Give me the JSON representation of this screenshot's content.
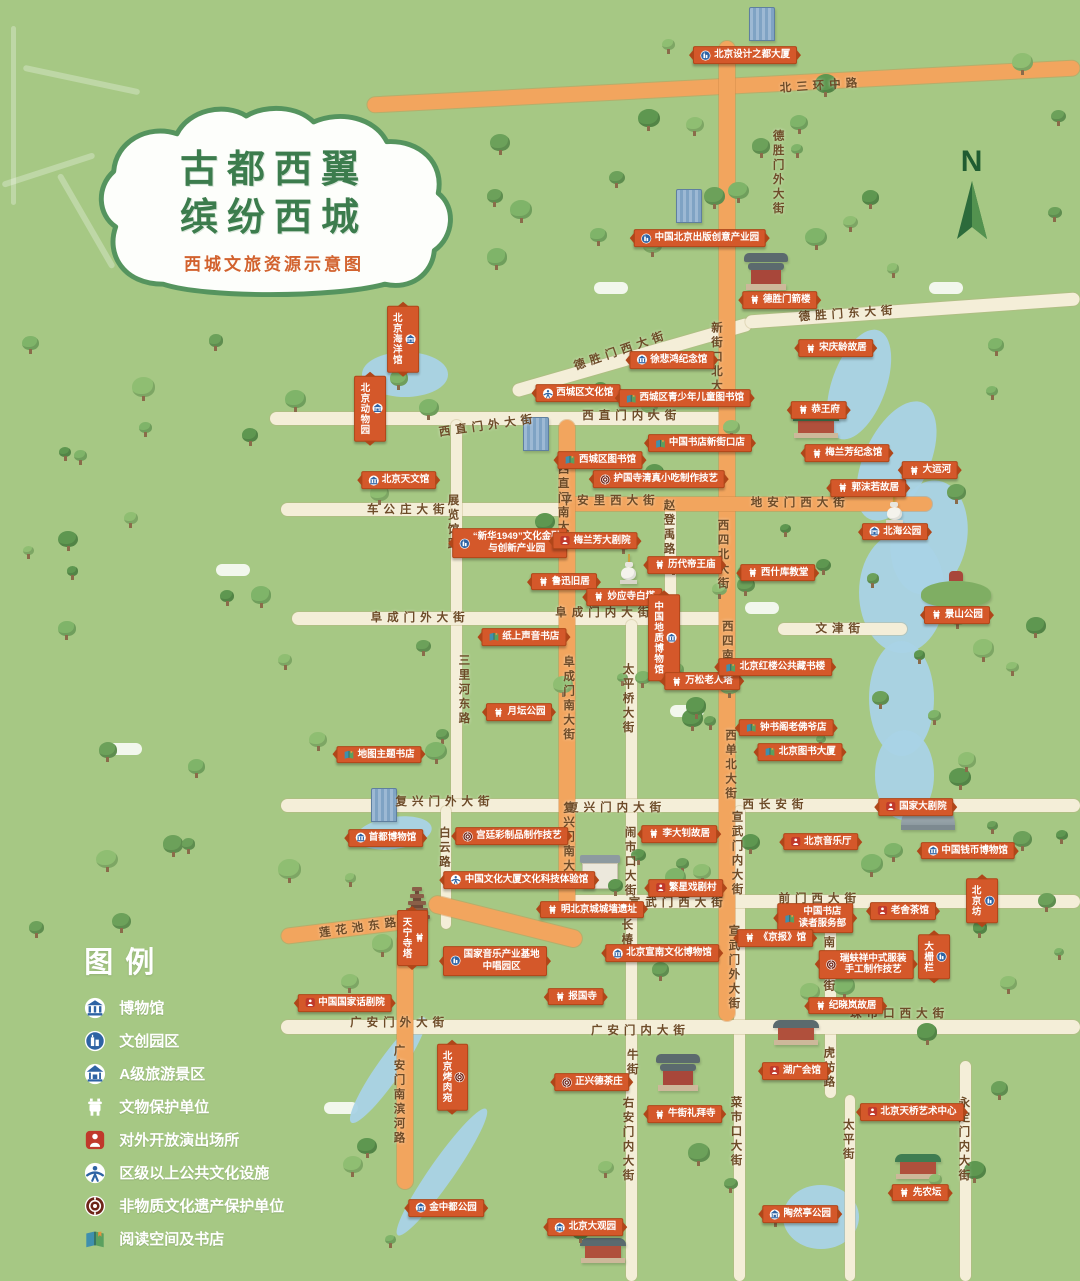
{
  "title": {
    "line1": "古都西翼",
    "line2": "缤纷西城",
    "subtitle": "西城文旅资源示意图"
  },
  "compass": {
    "label": "N"
  },
  "colors": {
    "background": "#a6c884",
    "road_main": "#f2a55e",
    "road_secondary": "#f4eed8",
    "water": "#a9d3e6",
    "banner": "#d4582a",
    "title_green": "#3c7c4d",
    "subtitle_orange": "#d2622e"
  },
  "legend": {
    "title": "图例",
    "items": [
      {
        "type": "museum",
        "label": "博物馆"
      },
      {
        "type": "creative",
        "label": "文创园区"
      },
      {
        "type": "scenic",
        "label": "A级旅游景区"
      },
      {
        "type": "heritage",
        "label": "文物保护单位"
      },
      {
        "type": "performance",
        "label": "对外开放演出场所"
      },
      {
        "type": "culture",
        "label": "区级以上公共文化设施"
      },
      {
        "type": "ich",
        "label": "非物质文化遗产保护单位"
      },
      {
        "type": "bookstore",
        "label": "阅读空间及书店"
      }
    ]
  },
  "map": {
    "orange_segments": [
      {
        "x": 34,
        "y": 6.2,
        "w": 66,
        "h": 1.2,
        "rot": -3
      },
      {
        "x": 66.6,
        "y": 3.2,
        "w": 1.5,
        "h": 76.5
      },
      {
        "x": 52.3,
        "y": 38.8,
        "w": 34,
        "h": 1.1
      },
      {
        "x": 51.8,
        "y": 32.8,
        "w": 1.4,
        "h": 38.6
      },
      {
        "x": 39.5,
        "y": 71.3,
        "w": 14.5,
        "h": 1.3,
        "rot": 14
      },
      {
        "x": 36.8,
        "y": 72.8,
        "w": 1.4,
        "h": 20
      },
      {
        "x": 26,
        "y": 71.9,
        "w": 12.5,
        "h": 1.2,
        "rot": -7
      }
    ],
    "cream_segments": [
      {
        "x": 47,
        "y": 27.4,
        "w": 23,
        "h": 1,
        "rot": -16
      },
      {
        "x": 69,
        "y": 23.7,
        "w": 31,
        "h": 1,
        "rot": -4
      },
      {
        "x": 25,
        "y": 32.2,
        "w": 43,
        "h": 1
      },
      {
        "x": 26,
        "y": 39.3,
        "w": 26.5,
        "h": 1
      },
      {
        "x": 41.8,
        "y": 32.8,
        "w": 1,
        "h": 29.8
      },
      {
        "x": 27,
        "y": 47.8,
        "w": 40.5,
        "h": 1
      },
      {
        "x": 61.6,
        "y": 39.6,
        "w": 1,
        "h": 8.4
      },
      {
        "x": 58,
        "y": 48.4,
        "w": 1,
        "h": 51.6
      },
      {
        "x": 72,
        "y": 48.6,
        "w": 12,
        "h": 1
      },
      {
        "x": 26,
        "y": 62.4,
        "w": 74,
        "h": 1
      },
      {
        "x": 40.8,
        "y": 62.9,
        "w": 1,
        "h": 9.6
      },
      {
        "x": 68,
        "y": 62.9,
        "w": 1,
        "h": 37.1
      },
      {
        "x": 52.8,
        "y": 69.9,
        "w": 47.2,
        "h": 1
      },
      {
        "x": 76.4,
        "y": 70.4,
        "w": 1,
        "h": 8.7
      },
      {
        "x": 76.4,
        "y": 79.9,
        "w": 1,
        "h": 5.8
      },
      {
        "x": 78.2,
        "y": 85.5,
        "w": 1,
        "h": 14.5
      },
      {
        "x": 26,
        "y": 79.6,
        "w": 74,
        "h": 1.1
      },
      {
        "x": 88.9,
        "y": 82.8,
        "w": 1,
        "h": 17.2
      }
    ],
    "road_labels": [
      {
        "name": "北三环中路",
        "x": 76,
        "y": 6.6,
        "dir": "h",
        "rot": -4
      },
      {
        "name": "德胜门外大街",
        "x": 72,
        "y": 13.5,
        "dir": "v"
      },
      {
        "name": "德胜门东大街",
        "x": 78.5,
        "y": 24.4,
        "dir": "h",
        "rot": -4
      },
      {
        "name": "德胜门西大街",
        "x": 57.5,
        "y": 27.3,
        "dir": "h",
        "rot": -19
      },
      {
        "name": "新街口北大街",
        "x": 66.3,
        "y": 28.5,
        "dir": "v"
      },
      {
        "name": "西直门外大街",
        "x": 45.2,
        "y": 33.2,
        "dir": "h",
        "rot": -8
      },
      {
        "name": "西直门内大街",
        "x": 58.5,
        "y": 32.4,
        "dir": "h"
      },
      {
        "name": "西直门南大街",
        "x": 52.1,
        "y": 39.5,
        "dir": "v"
      },
      {
        "name": "车公庄大街",
        "x": 37.8,
        "y": 39.7,
        "dir": "h"
      },
      {
        "name": "展览馆路",
        "x": 41.9,
        "y": 40.8,
        "dir": "v"
      },
      {
        "name": "平安里西大街",
        "x": 56.5,
        "y": 39,
        "dir": "h"
      },
      {
        "name": "地安门西大街",
        "x": 74.1,
        "y": 39.2,
        "dir": "h"
      },
      {
        "name": "赵登禹路",
        "x": 61.9,
        "y": 41.2,
        "dir": "v"
      },
      {
        "name": "西四北大街",
        "x": 66.9,
        "y": 43.3,
        "dir": "v"
      },
      {
        "name": "阜成门外大街",
        "x": 38.9,
        "y": 48.2,
        "dir": "h"
      },
      {
        "name": "阜成门内大街",
        "x": 56,
        "y": 47.8,
        "dir": "h"
      },
      {
        "name": "文津街",
        "x": 77.8,
        "y": 49,
        "dir": "h"
      },
      {
        "name": "阜成门南大街",
        "x": 52.6,
        "y": 54.6,
        "dir": "v"
      },
      {
        "name": "三里河东路",
        "x": 42.9,
        "y": 53.9,
        "dir": "v"
      },
      {
        "name": "西四南大街",
        "x": 67.3,
        "y": 51.2,
        "dir": "v"
      },
      {
        "name": "太平桥大街",
        "x": 58.1,
        "y": 54.6,
        "dir": "v"
      },
      {
        "name": "复兴门外大街",
        "x": 41.2,
        "y": 62.5,
        "dir": "h"
      },
      {
        "name": "复兴门内大街",
        "x": 57.1,
        "y": 63,
        "dir": "h"
      },
      {
        "name": "复兴门南大街",
        "x": 52.6,
        "y": 66,
        "dir": "v"
      },
      {
        "name": "白云路",
        "x": 41.1,
        "y": 66.2,
        "dir": "v"
      },
      {
        "name": "西长安街",
        "x": 71.8,
        "y": 62.8,
        "dir": "h"
      },
      {
        "name": "西单北大街",
        "x": 67.6,
        "y": 59.7,
        "dir": "v"
      },
      {
        "name": "闹市口大街",
        "x": 58.3,
        "y": 67.3,
        "dir": "v"
      },
      {
        "name": "宣武门内大街",
        "x": 68.2,
        "y": 66.7,
        "dir": "v"
      },
      {
        "name": "前门西大街",
        "x": 75.9,
        "y": 70.1,
        "dir": "h"
      },
      {
        "name": "宣武门西大街",
        "x": 62.8,
        "y": 70.4,
        "dir": "h"
      },
      {
        "name": "长椿街",
        "x": 58,
        "y": 73.4,
        "dir": "v"
      },
      {
        "name": "宣武门外大街",
        "x": 67.9,
        "y": 75.6,
        "dir": "v"
      },
      {
        "name": "南新华街",
        "x": 76.7,
        "y": 75.3,
        "dir": "v"
      },
      {
        "name": "莲花池东路",
        "x": 33.3,
        "y": 72.4,
        "dir": "h",
        "rot": -8
      },
      {
        "name": "广安门外大街",
        "x": 37,
        "y": 79.8,
        "dir": "h"
      },
      {
        "name": "广安门内大街",
        "x": 59.3,
        "y": 80.4,
        "dir": "h"
      },
      {
        "name": "珠市口西大街",
        "x": 83.3,
        "y": 79.1,
        "dir": "h"
      },
      {
        "name": "牛街",
        "x": 58.5,
        "y": 83,
        "dir": "v"
      },
      {
        "name": "右安门内大街",
        "x": 58.1,
        "y": 89,
        "dir": "v"
      },
      {
        "name": "广安门南滨河路",
        "x": 36.9,
        "y": 85.5,
        "dir": "v"
      },
      {
        "name": "菜市口大街",
        "x": 68.1,
        "y": 88.4,
        "dir": "v"
      },
      {
        "name": "太平街",
        "x": 78.5,
        "y": 89,
        "dir": "v"
      },
      {
        "name": "虎坊路",
        "x": 76.7,
        "y": 83.4,
        "dir": "v"
      },
      {
        "name": "永定门内大街",
        "x": 89.2,
        "y": 89,
        "dir": "v"
      }
    ],
    "pois": [
      {
        "name": "北京设计之都大厦",
        "type": "creative",
        "x": 69,
        "y": 4.3
      },
      {
        "name": "中国北京出版创意产业园",
        "type": "creative",
        "x": 64.8,
        "y": 18.6
      },
      {
        "name": "德胜门箭楼",
        "type": "heritage",
        "x": 72.2,
        "y": 23.4
      },
      {
        "name": "宋庆龄故居",
        "type": "heritage",
        "x": 77.4,
        "y": 27.2
      },
      {
        "name": "徐悲鸿纪念馆",
        "type": "museum",
        "x": 62.2,
        "y": 28.1
      },
      {
        "name": "西城区文化馆",
        "type": "culture",
        "x": 53.5,
        "y": 30.7
      },
      {
        "name": "西城区青少年儿童图书馆",
        "type": "bookstore",
        "x": 63.4,
        "y": 31.1
      },
      {
        "name": "中国书店新街口店",
        "type": "bookstore",
        "x": 64.8,
        "y": 34.6
      },
      {
        "name": "西城区图书馆",
        "type": "bookstore",
        "x": 55.6,
        "y": 35.9
      },
      {
        "name": "护国寺清真小吃制作技艺",
        "type": "ich",
        "x": 61,
        "y": 37.4
      },
      {
        "name": "北京海洋馆",
        "type": "scenic",
        "x": 37.3,
        "y": 26.5,
        "v": true
      },
      {
        "name": "北京动物园",
        "type": "scenic",
        "x": 34.3,
        "y": 31.9,
        "v": true
      },
      {
        "name": "北京天文馆",
        "type": "museum",
        "x": 36.9,
        "y": 37.5
      },
      {
        "name": "“新华1949”文化金融\n与创新产业园",
        "type": "creative",
        "x": 47.2,
        "y": 42.4
      },
      {
        "name": "梅兰芳大剧院",
        "type": "performance",
        "x": 55.1,
        "y": 42.2
      },
      {
        "name": "鲁迅旧居",
        "type": "heritage",
        "x": 52.2,
        "y": 45.4
      },
      {
        "name": "妙应寺白塔",
        "type": "heritage",
        "x": 57.8,
        "y": 46.6
      },
      {
        "name": "历代帝王庙",
        "type": "heritage",
        "x": 63.4,
        "y": 44.1
      },
      {
        "name": "西什库教堂",
        "type": "heritage",
        "x": 72,
        "y": 44.7
      },
      {
        "name": "北海公园",
        "type": "scenic",
        "x": 82.9,
        "y": 41.5
      },
      {
        "name": "恭王府",
        "type": "heritage",
        "x": 75.8,
        "y": 32
      },
      {
        "name": "梅兰芳纪念馆",
        "type": "heritage",
        "x": 78.4,
        "y": 35.4
      },
      {
        "name": "郭沫若故居",
        "type": "heritage",
        "x": 80.4,
        "y": 38.1
      },
      {
        "name": "大运河",
        "type": "heritage",
        "x": 86.1,
        "y": 36.7
      },
      {
        "name": "景山公园",
        "type": "heritage",
        "x": 88.6,
        "y": 48
      },
      {
        "name": "纸上声音书店",
        "type": "bookstore",
        "x": 48.5,
        "y": 49.7
      },
      {
        "name": "月坛公园",
        "type": "heritage",
        "x": 48.1,
        "y": 55.6
      },
      {
        "name": "中国地质博物馆",
        "type": "museum",
        "x": 61.5,
        "y": 49.8,
        "v": true
      },
      {
        "name": "万松老人塔",
        "type": "heritage",
        "x": 65,
        "y": 53.2
      },
      {
        "name": "北京红楼公共藏书楼",
        "type": "bookstore",
        "x": 71.8,
        "y": 52.1
      },
      {
        "name": "地图主题书店",
        "type": "bookstore",
        "x": 35.1,
        "y": 58.9
      },
      {
        "name": "首都博物馆",
        "type": "museum",
        "x": 35.7,
        "y": 65.4
      },
      {
        "name": "钟书阁老佛爷店",
        "type": "bookstore",
        "x": 72.8,
        "y": 56.8
      },
      {
        "name": "北京图书大厦",
        "type": "bookstore",
        "x": 74.1,
        "y": 58.7
      },
      {
        "name": "李大钊故居",
        "type": "heritage",
        "x": 62.9,
        "y": 65.1
      },
      {
        "name": "北京音乐厅",
        "type": "performance",
        "x": 76,
        "y": 65.7
      },
      {
        "name": "国家大剧院",
        "type": "performance",
        "x": 84.8,
        "y": 63
      },
      {
        "name": "中国钱币博物馆",
        "type": "museum",
        "x": 89.6,
        "y": 66.4
      },
      {
        "name": "繁星戏剧村",
        "type": "performance",
        "x": 63.5,
        "y": 69.3
      },
      {
        "name": "宫廷彩制品制作技艺",
        "type": "ich",
        "x": 47.4,
        "y": 65.3
      },
      {
        "name": "中国文化大厦文化科技体验馆",
        "type": "culture",
        "x": 48.1,
        "y": 68.7
      },
      {
        "name": "明北京城城墙遗址",
        "type": "heritage",
        "x": 54.8,
        "y": 71
      },
      {
        "name": "中国书店\n读者服务部",
        "type": "bookstore",
        "x": 75.5,
        "y": 71.7
      },
      {
        "name": "老舍茶馆",
        "type": "performance",
        "x": 83.6,
        "y": 71.1
      },
      {
        "name": "北京坊",
        "type": "creative",
        "x": 90.9,
        "y": 70.3,
        "v": true
      },
      {
        "name": "大栅栏",
        "type": "creative",
        "x": 86.5,
        "y": 74.7,
        "v": true
      },
      {
        "name": "《京报》馆",
        "type": "heritage",
        "x": 71.8,
        "y": 73.2
      },
      {
        "name": "瑞蚨祥中式服装\n手工制作技艺",
        "type": "ich",
        "x": 80.2,
        "y": 75.3
      },
      {
        "name": "北京宣南文化博物馆",
        "type": "museum",
        "x": 61.3,
        "y": 74.4
      },
      {
        "name": "纪晓岚故居",
        "type": "heritage",
        "x": 78.3,
        "y": 78.5
      },
      {
        "name": "中国国家话剧院",
        "type": "performance",
        "x": 31.9,
        "y": 78.3
      },
      {
        "name": "天宁寺塔",
        "type": "heritage",
        "x": 38.2,
        "y": 73.2,
        "v": true
      },
      {
        "name": "国家音乐产业基地\n中唱园区",
        "type": "creative",
        "x": 45.8,
        "y": 75
      },
      {
        "name": "报国寺",
        "type": "heritage",
        "x": 53.3,
        "y": 77.8
      },
      {
        "name": "正兴德茶庄",
        "type": "ich",
        "x": 54.8,
        "y": 84.5
      },
      {
        "name": "北京烤肉宛",
        "type": "ich",
        "x": 41.9,
        "y": 84.1,
        "v": true
      },
      {
        "name": "牛街礼拜寺",
        "type": "heritage",
        "x": 63.4,
        "y": 87
      },
      {
        "name": "湖广会馆",
        "type": "performance",
        "x": 73.6,
        "y": 83.6
      },
      {
        "name": "北京天桥艺术中心",
        "type": "performance",
        "x": 84.4,
        "y": 86.8
      },
      {
        "name": "先农坛",
        "type": "heritage",
        "x": 85.2,
        "y": 93.1
      },
      {
        "name": "陶然亭公园",
        "type": "scenic",
        "x": 74.1,
        "y": 94.8
      },
      {
        "name": "北京大观园",
        "type": "scenic",
        "x": 54.2,
        "y": 95.8
      },
      {
        "name": "金中都公园",
        "type": "scenic",
        "x": 41.3,
        "y": 94.3
      }
    ]
  }
}
